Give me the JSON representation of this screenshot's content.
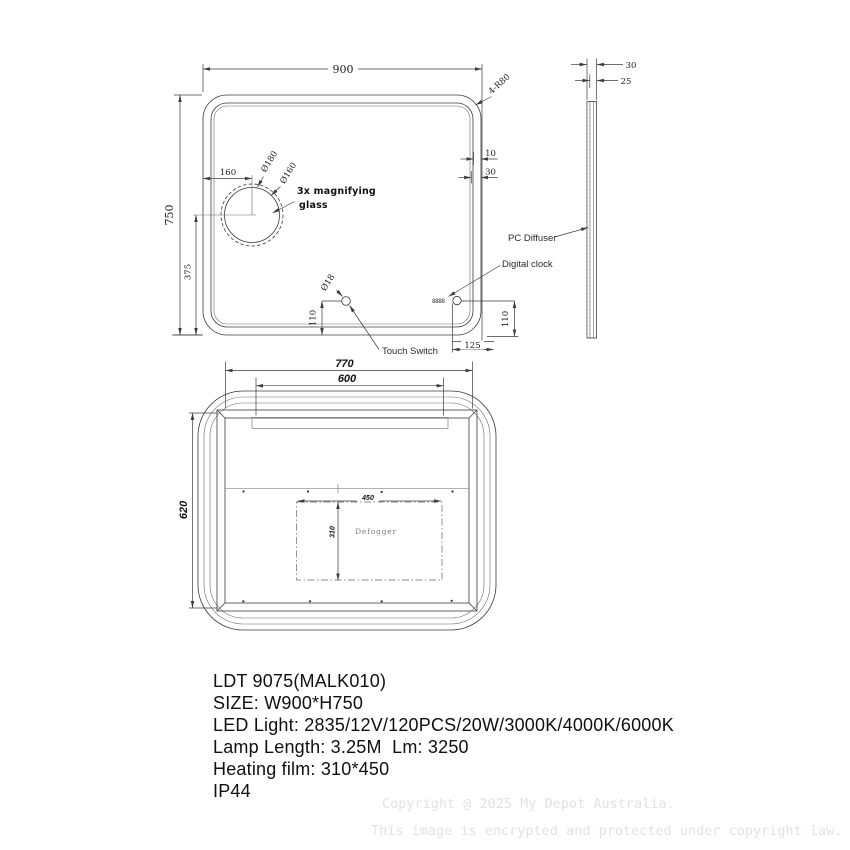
{
  "front_view": {
    "width_dim": "900",
    "height_dim": "750",
    "corner_note": "4-R80",
    "circle_offset_dim": "160",
    "circle_outer_dia": "Ø180",
    "circle_inner_dia": "Ø160",
    "magnifier_label_line1": "3x magnifying",
    "magnifier_label_line2": "glass",
    "center_height_dim": "375",
    "touch_dia": "Ø18",
    "touch_height_dim": "110",
    "touch_label": "Touch Switch",
    "clock_label": "Digital clock",
    "clock_display": "8888",
    "clock_height_dim": "110",
    "clock_offset_dim": "125",
    "edge_band_dim": "10",
    "edge_frame_dim": "30"
  },
  "side_view": {
    "depth_dim": "30",
    "body_depth_dim": "25",
    "diffuser_label": "PC Diffuser"
  },
  "back_view": {
    "frame_width_dim": "770",
    "bracket_width_dim": "600",
    "height_dim": "620",
    "defogger_width_dim": "450",
    "defogger_height_dim": "310",
    "defogger_label": "Defogger"
  },
  "specs": {
    "model": "LDT 9075(MALK010)",
    "size": "SIZE: W900*H750",
    "led": "LED Light: 2835/12V/120PCS/20W/3000K/4000K/6000K",
    "lamp": "Lamp Length: 3.25M  Lm: 3250",
    "heating": "Heating film: 310*450",
    "ip": "IP44"
  },
  "watermark": {
    "line1": "Copyright @ 2025 My Depot Australia.",
    "line2": "This image is encrypted and protected under copyright law."
  }
}
